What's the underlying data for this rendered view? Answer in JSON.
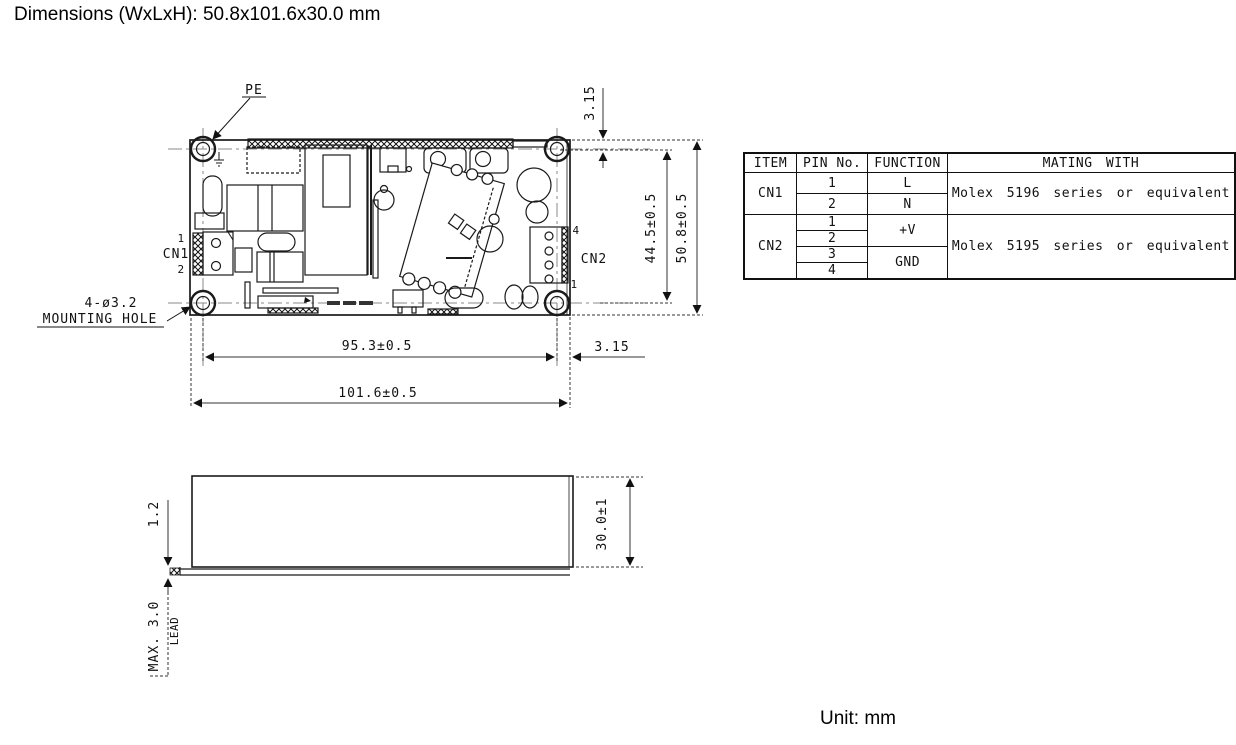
{
  "title": "Dimensions (WxLxH): 50.8x101.6x30.0 mm",
  "unit_note": "Unit: mm",
  "top_view": {
    "labels": {
      "pe": "PE",
      "cn1": "CN1",
      "cn1_pin1": "1",
      "cn1_pin2": "2",
      "cn2": "CN2",
      "cn2_pin4": "4",
      "cn2_pin1": "1",
      "mounting_hole_line1": "4-ø3.2",
      "mounting_hole_line2": "MOUNTING HOLE"
    },
    "dimensions": {
      "hole_offset_top": "3.15",
      "hole_span_vertical": "44.5±0.5",
      "board_width": "50.8±0.5",
      "hole_span_horizontal": "95.3±0.5",
      "hole_offset_right": "3.15",
      "board_length": "101.6±0.5"
    }
  },
  "side_view": {
    "dimensions": {
      "pcb_thickness": "1.2",
      "case_height": "30.0±1",
      "lead_max": "MAX. 3.0",
      "lead_label": "LEAD"
    }
  },
  "table": {
    "headers": [
      "ITEM",
      "PIN No.",
      "FUNCTION",
      "MATING WITH"
    ],
    "rows": [
      {
        "item": "CN1",
        "pins": [
          "1",
          "2"
        ],
        "functions": [
          "L",
          "N"
        ],
        "mating": "Molex 5196 series or equivalent"
      },
      {
        "item": "CN2",
        "pins": [
          "1",
          "2",
          "3",
          "4"
        ],
        "functions": [
          "+V",
          "GND"
        ],
        "mating": "Molex 5195 series or equivalent"
      }
    ]
  },
  "colors": {
    "line": "#1a1a1a",
    "centerline": "#888888",
    "background": "#ffffff"
  }
}
